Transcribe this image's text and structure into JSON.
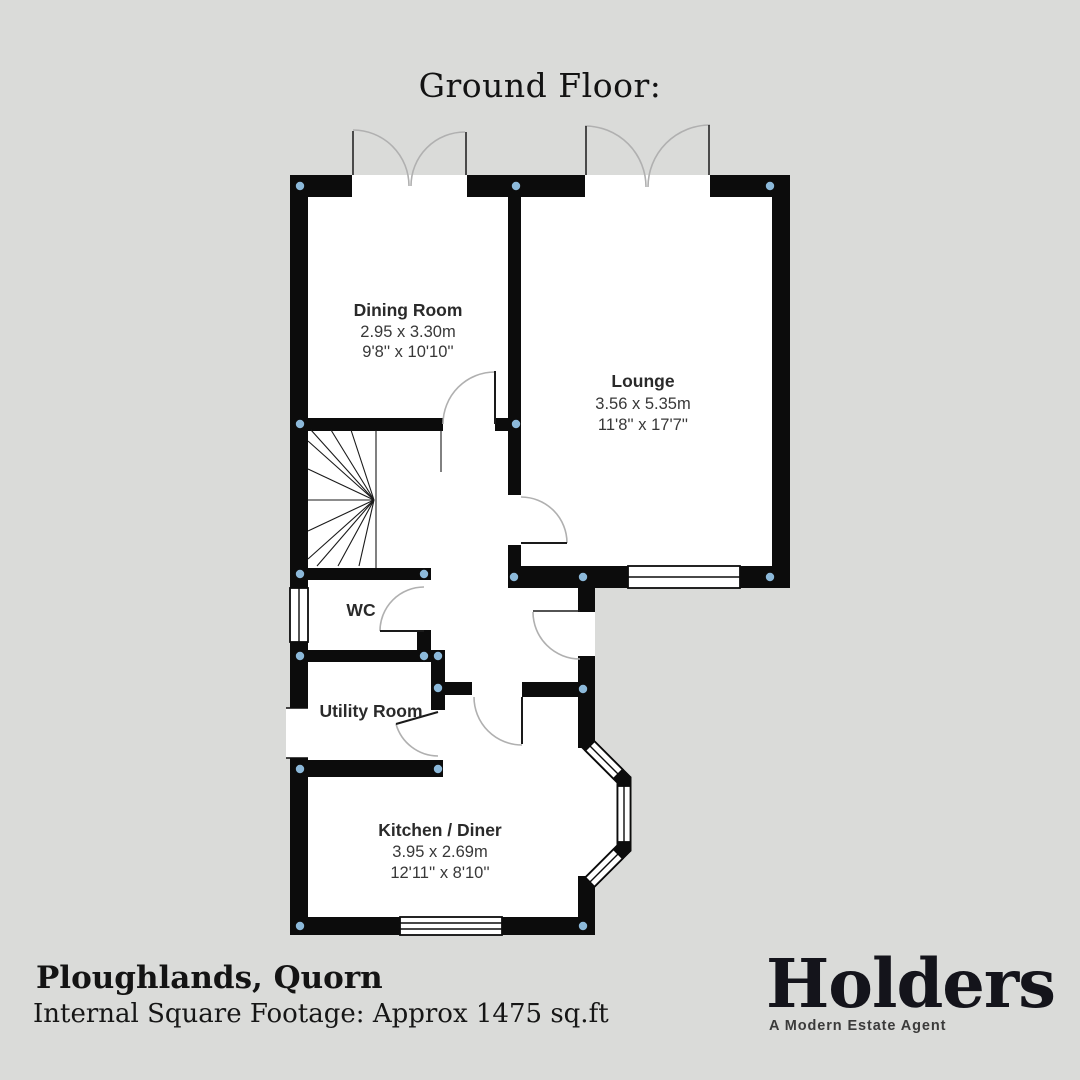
{
  "page": {
    "title": "Ground Floor:"
  },
  "plan": {
    "rooms": [
      {
        "name": "Dining Room",
        "metric": "2.95 x 3.30m",
        "imperial": "9'8'' x 10'10''"
      },
      {
        "name": "Lounge",
        "metric": "3.56 x 5.35m",
        "imperial": "11'8'' x 17'7''"
      },
      {
        "name": "WC",
        "metric": "",
        "imperial": ""
      },
      {
        "name": "Utility Room",
        "metric": "",
        "imperial": ""
      },
      {
        "name": "Kitchen / Diner",
        "metric": "3.95 x 2.69m",
        "imperial": "12'11'' x 8'10''"
      }
    ],
    "features": [
      "staircase",
      "bay-window",
      "french-doors-dining",
      "french-doors-lounge"
    ]
  },
  "footer": {
    "property_name": "Ploughlands, Quorn",
    "square_footage": "Internal Square Footage: Approx 1475 sq.ft"
  },
  "brand": {
    "name": "Holders",
    "tagline": "A Modern Estate Agent"
  },
  "colors": {
    "background": "#dadbd9",
    "wall": "#0c0c0c",
    "floor": "#ffffff",
    "junction_dot": "#8cb9da",
    "door_arc": "#b0b0b0",
    "label_text": "#2a2a2a"
  }
}
